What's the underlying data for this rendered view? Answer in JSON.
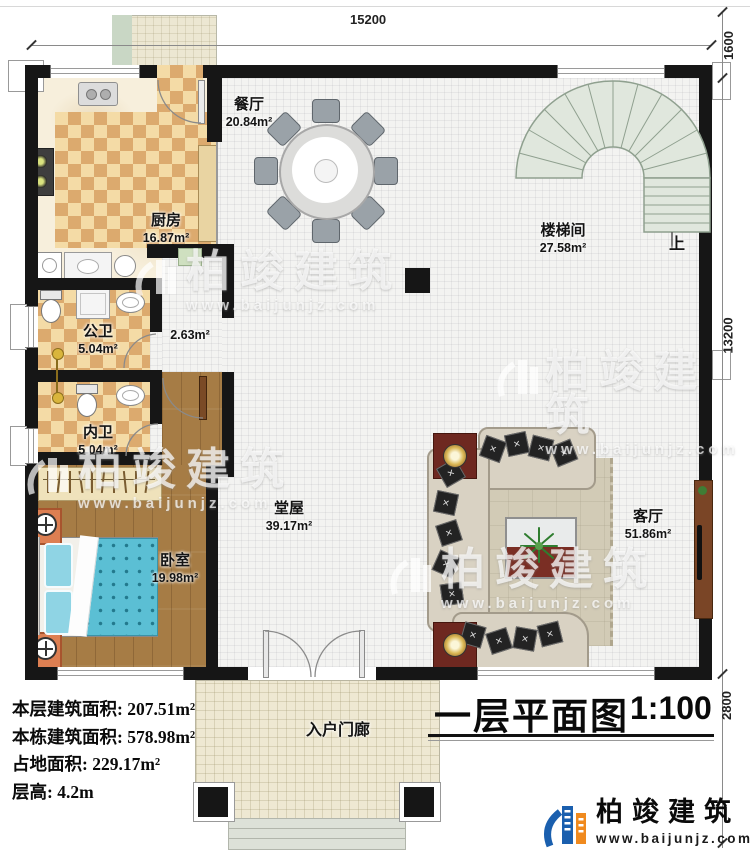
{
  "plan": {
    "title": "一层平面图",
    "scale": "1:100",
    "stairs_up": "上"
  },
  "dimensions": {
    "top": "15200",
    "right_top": "1600",
    "right_middle": "13200",
    "right_bottom": "2800"
  },
  "rooms": {
    "dining": {
      "name": "餐厅",
      "area": "20.84m²"
    },
    "kitchen": {
      "name": "厨房",
      "area": "16.87m²"
    },
    "stairwell": {
      "name": "楼梯间",
      "area": "27.58m²"
    },
    "public_bath": {
      "name": "公卫",
      "area": "5.04m²"
    },
    "private_bath": {
      "name": "内卫",
      "area": "5.04m²"
    },
    "bedroom": {
      "name": "卧室",
      "area": "19.98m²"
    },
    "hall": {
      "name": "堂屋",
      "area": "39.17m²"
    },
    "living": {
      "name": "客厅",
      "area": "51.86m²"
    },
    "porch": {
      "name": "入户门廊"
    },
    "corridor": {
      "area": "2.63m²"
    }
  },
  "stats": {
    "floor_area": {
      "label": "本层建筑面积:",
      "value": "207.51m²"
    },
    "building_area": {
      "label": "本栋建筑面积:",
      "value": "578.98m²"
    },
    "footprint": {
      "label": "占地面积:",
      "value": "229.17m²"
    },
    "height": {
      "label": "层高:",
      "value": "4.2m"
    }
  },
  "branding": {
    "company": "柏竣建筑",
    "website": "www.baijunjz.com"
  },
  "colors": {
    "wall": "#161616",
    "checker_dark": "#dcaa6e",
    "checker_light": "#f4dba6",
    "wood": "#a67c45",
    "stair": "#e0e7dd",
    "bed": "#5bbfd4",
    "nightstand": "#dd7f52",
    "brand_blue": "#1a5fae",
    "brand_orange": "#f08a1e"
  }
}
